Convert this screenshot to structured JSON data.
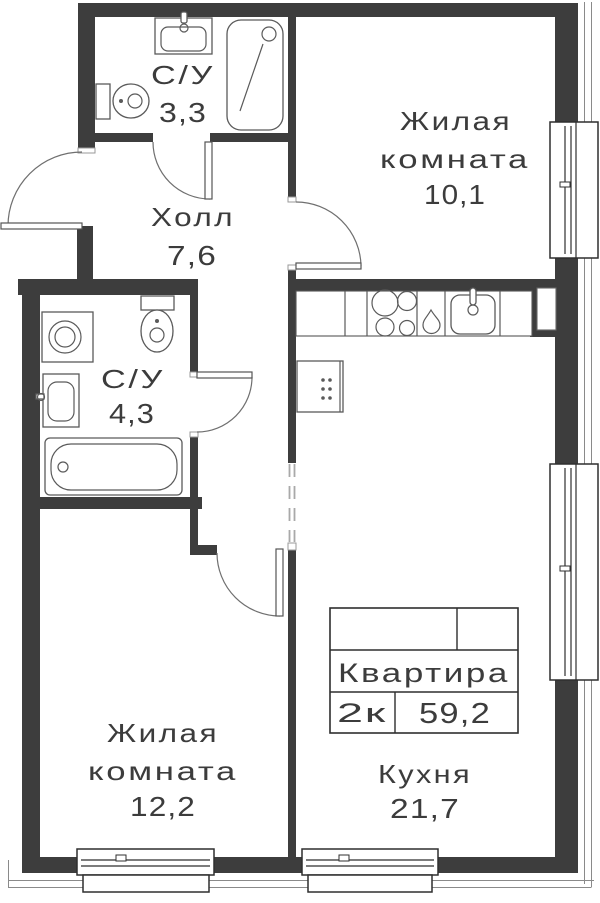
{
  "plan": {
    "info_table": {
      "title": "Квартира",
      "rooms": "2к",
      "area": "59,2"
    },
    "rooms": [
      {
        "id": "bathroom-1",
        "name": "С/У",
        "area": "3,3"
      },
      {
        "id": "living-room-1",
        "name_l1": "Жилая",
        "name_l2": "комната",
        "area": "10,1"
      },
      {
        "id": "hall",
        "name": "Холл",
        "area": "7,6"
      },
      {
        "id": "bathroom-2",
        "name": "С/У",
        "area": "4,3"
      },
      {
        "id": "kitchen",
        "name": "Кухня",
        "area": "21,7"
      },
      {
        "id": "living-room-2",
        "name_l1": "Жилая",
        "name_l2": "комната",
        "area": "12,2"
      }
    ],
    "fixtures": [
      "toilet-icon",
      "sink-icon",
      "shower-icon",
      "bathtub-icon",
      "washing-machine-icon",
      "stove-icon",
      "kitchen-sink-icon",
      "tap-drop-icon",
      "cabinet-icon"
    ],
    "colors": {
      "wall": "#3d3d3d",
      "line": "#2f2f2f",
      "fixture": "#5a5a5a",
      "door": "#6f6f6f",
      "text": "#3c3c3c",
      "dash": "#a9a9a9",
      "facade": "#8a8a8a",
      "bg": "#ffffff"
    }
  }
}
